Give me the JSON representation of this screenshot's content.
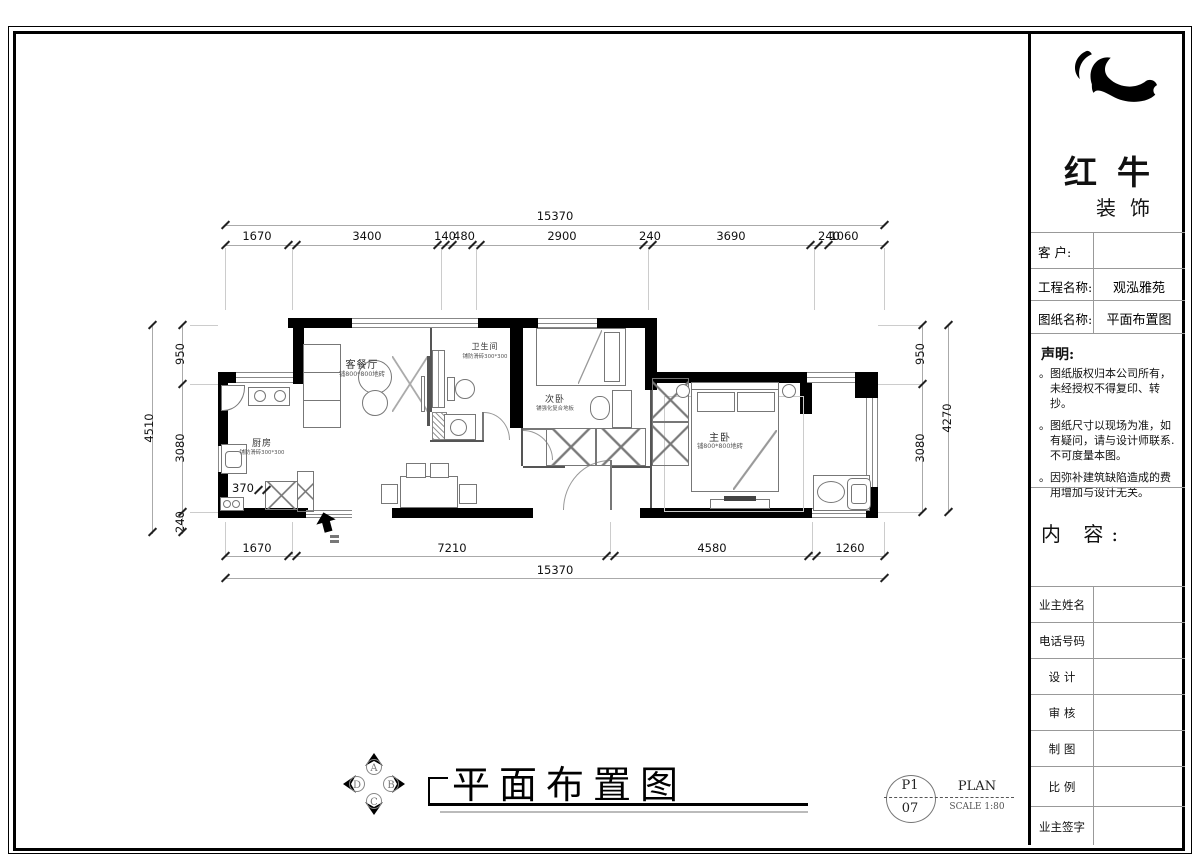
{
  "titleblock": {
    "brand": {
      "line1": "红牛",
      "line2": "装饰"
    },
    "fields": [
      {
        "label": "客  户:",
        "value": ""
      },
      {
        "label": "工程名称:",
        "value": "观泓雅苑"
      },
      {
        "label": "图纸名称:",
        "value": "平面布置图"
      }
    ],
    "statement": {
      "title": "声明:",
      "items": [
        "图纸版权归本公司所有，未经授权不得复印、转抄。",
        "图纸尺寸以现场为准，如有疑问，请与设计师联系. 不可度量本图。",
        "因弥补建筑缺陷造成的费用增加与设计无关。"
      ]
    },
    "content_label": "内 容:",
    "rows": [
      "业主姓名",
      "电话号码",
      "设 计",
      "审 核",
      "制 图",
      "比 例",
      "业主签字"
    ]
  },
  "plan": {
    "rooms": [
      {
        "name": "厨房",
        "note": "铺防滑砖300*300"
      },
      {
        "name": "客餐厅",
        "note": "铺800*800地砖"
      },
      {
        "name": "卫生间",
        "note": "铺防滑砖300*300"
      },
      {
        "name": "次卧",
        "note": "铺强化复合地板"
      },
      {
        "name": "主卧",
        "note": "铺800*800地砖"
      }
    ],
    "dims": {
      "top_total": "15370",
      "top": [
        "1670",
        "3400",
        "140",
        "480",
        "2900",
        "240",
        "3690",
        "240",
        "1060"
      ],
      "bottom": [
        "1670",
        "7210",
        "4580",
        "1260"
      ],
      "bottom_total": "15370",
      "left": [
        "950",
        "3080",
        "240"
      ],
      "left_total": "4510",
      "wall_dim": "370",
      "right": [
        "950",
        "3080"
      ],
      "right_total": "4270"
    }
  },
  "footer": {
    "title": "平面布置图",
    "compass": {
      "top": "A",
      "right": "B",
      "bottom": "C",
      "left": "D"
    },
    "sheet": {
      "top": "P1",
      "bottom": "07",
      "name": "PLAN",
      "scale": "SCALE 1:80"
    }
  }
}
